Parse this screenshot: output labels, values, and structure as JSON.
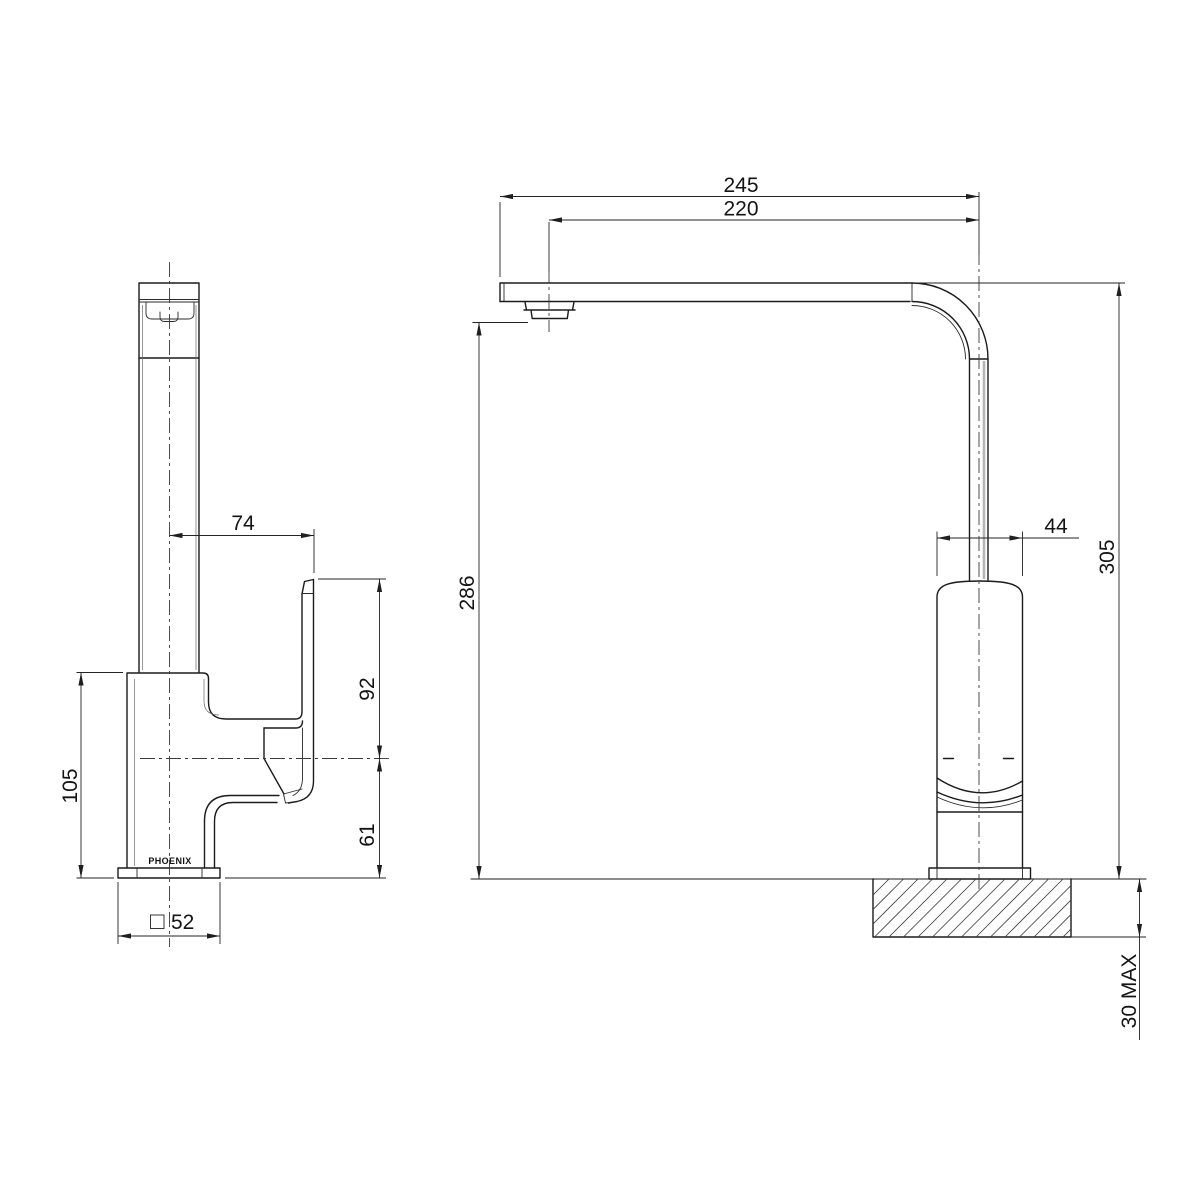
{
  "drawing": {
    "brand": "PHOENIX",
    "side_view": {
      "spout_center_to_handle": "74",
      "body_height": "105",
      "handle_top_to_outlet_center": "92",
      "outlet_center_to_base": "61",
      "base_width": "52"
    },
    "front_view": {
      "overall_reach": "245",
      "outlet_reach": "220",
      "outlet_clearance": "286",
      "body_width": "44",
      "overall_height": "305",
      "max_mounting_thickness": "30 MAX"
    },
    "colors": {
      "line": "#1b1b1b",
      "background": "#ffffff",
      "pipe_shading": "#b5b5b5"
    }
  }
}
